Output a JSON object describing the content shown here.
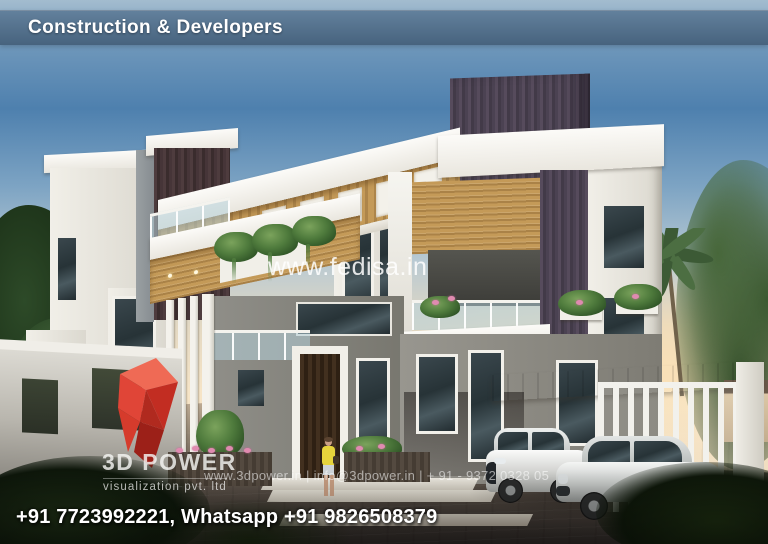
{
  "header": {
    "title": "Construction & Developers"
  },
  "watermarks": {
    "site": "www.fedisa.in",
    "contact": "www.3dpower.in | info@3dpower.in | + 91 - 9372 0328 05"
  },
  "logo": {
    "title": "3D POWER",
    "subtitle": "visualization pvt. ltd"
  },
  "footer": {
    "phones": "+91 7723992221, Whatsapp +91 9826508379"
  },
  "scene": {
    "subject": "modern two-storey bungalow 3D exterior render",
    "elements": [
      "white concrete volumes",
      "dark wood cladding tower",
      "wood pergola underside",
      "glass railings",
      "hanging planters",
      "carport with vertical slat screen",
      "two parked silver cars",
      "pedestrian in yellow top",
      "palm trees",
      "flying birds"
    ]
  },
  "colors": {
    "header_bg_top": "#62809c",
    "header_bg_bottom": "#47637e",
    "sky_top": "#a3bccf",
    "sky_mid": "#4e80ae",
    "sky_horizon": "#f6e4c6",
    "accent_red": "#d93a2b",
    "wood": "#c49a58",
    "dark_cladding": "#4a4150",
    "pavement_dark": "#2b2624"
  }
}
